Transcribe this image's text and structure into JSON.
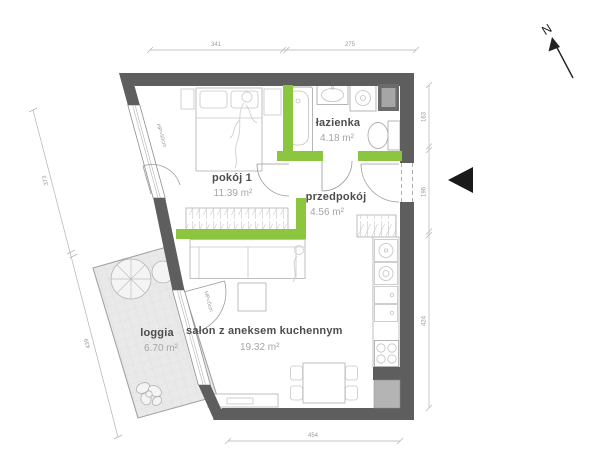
{
  "colors": {
    "wall": "#5e5e5e",
    "accent_green": "#8cc63f",
    "loggia_fill": "#e9e9e9",
    "shaft_light": "#b4b4b4",
    "shaft_dark": "#6b6b6b"
  },
  "rooms": [
    {
      "id": "pokoj1",
      "name": "pokój 1",
      "area_label": "11.39 m²"
    },
    {
      "id": "lazienka",
      "name": "łazienka",
      "area_label": "4.18 m²"
    },
    {
      "id": "przedpokoj",
      "name": "przedpokój",
      "area_label": "4.56 m²"
    },
    {
      "id": "salon",
      "name": "salon z aneksem kuchennym",
      "area_label": "19.32 m²"
    },
    {
      "id": "loggia",
      "name": "loggia",
      "area_label": "6.70 m²"
    }
  ],
  "dimensions": {
    "top": [
      "341",
      "275"
    ],
    "right": [
      "163",
      "196",
      "424"
    ],
    "bottom": [
      "454"
    ],
    "left": [
      "373",
      "439"
    ]
  },
  "windows": {
    "pokoj1": "HP=50cm",
    "salon": "HP=0cm"
  },
  "compass": {
    "label": "N"
  }
}
